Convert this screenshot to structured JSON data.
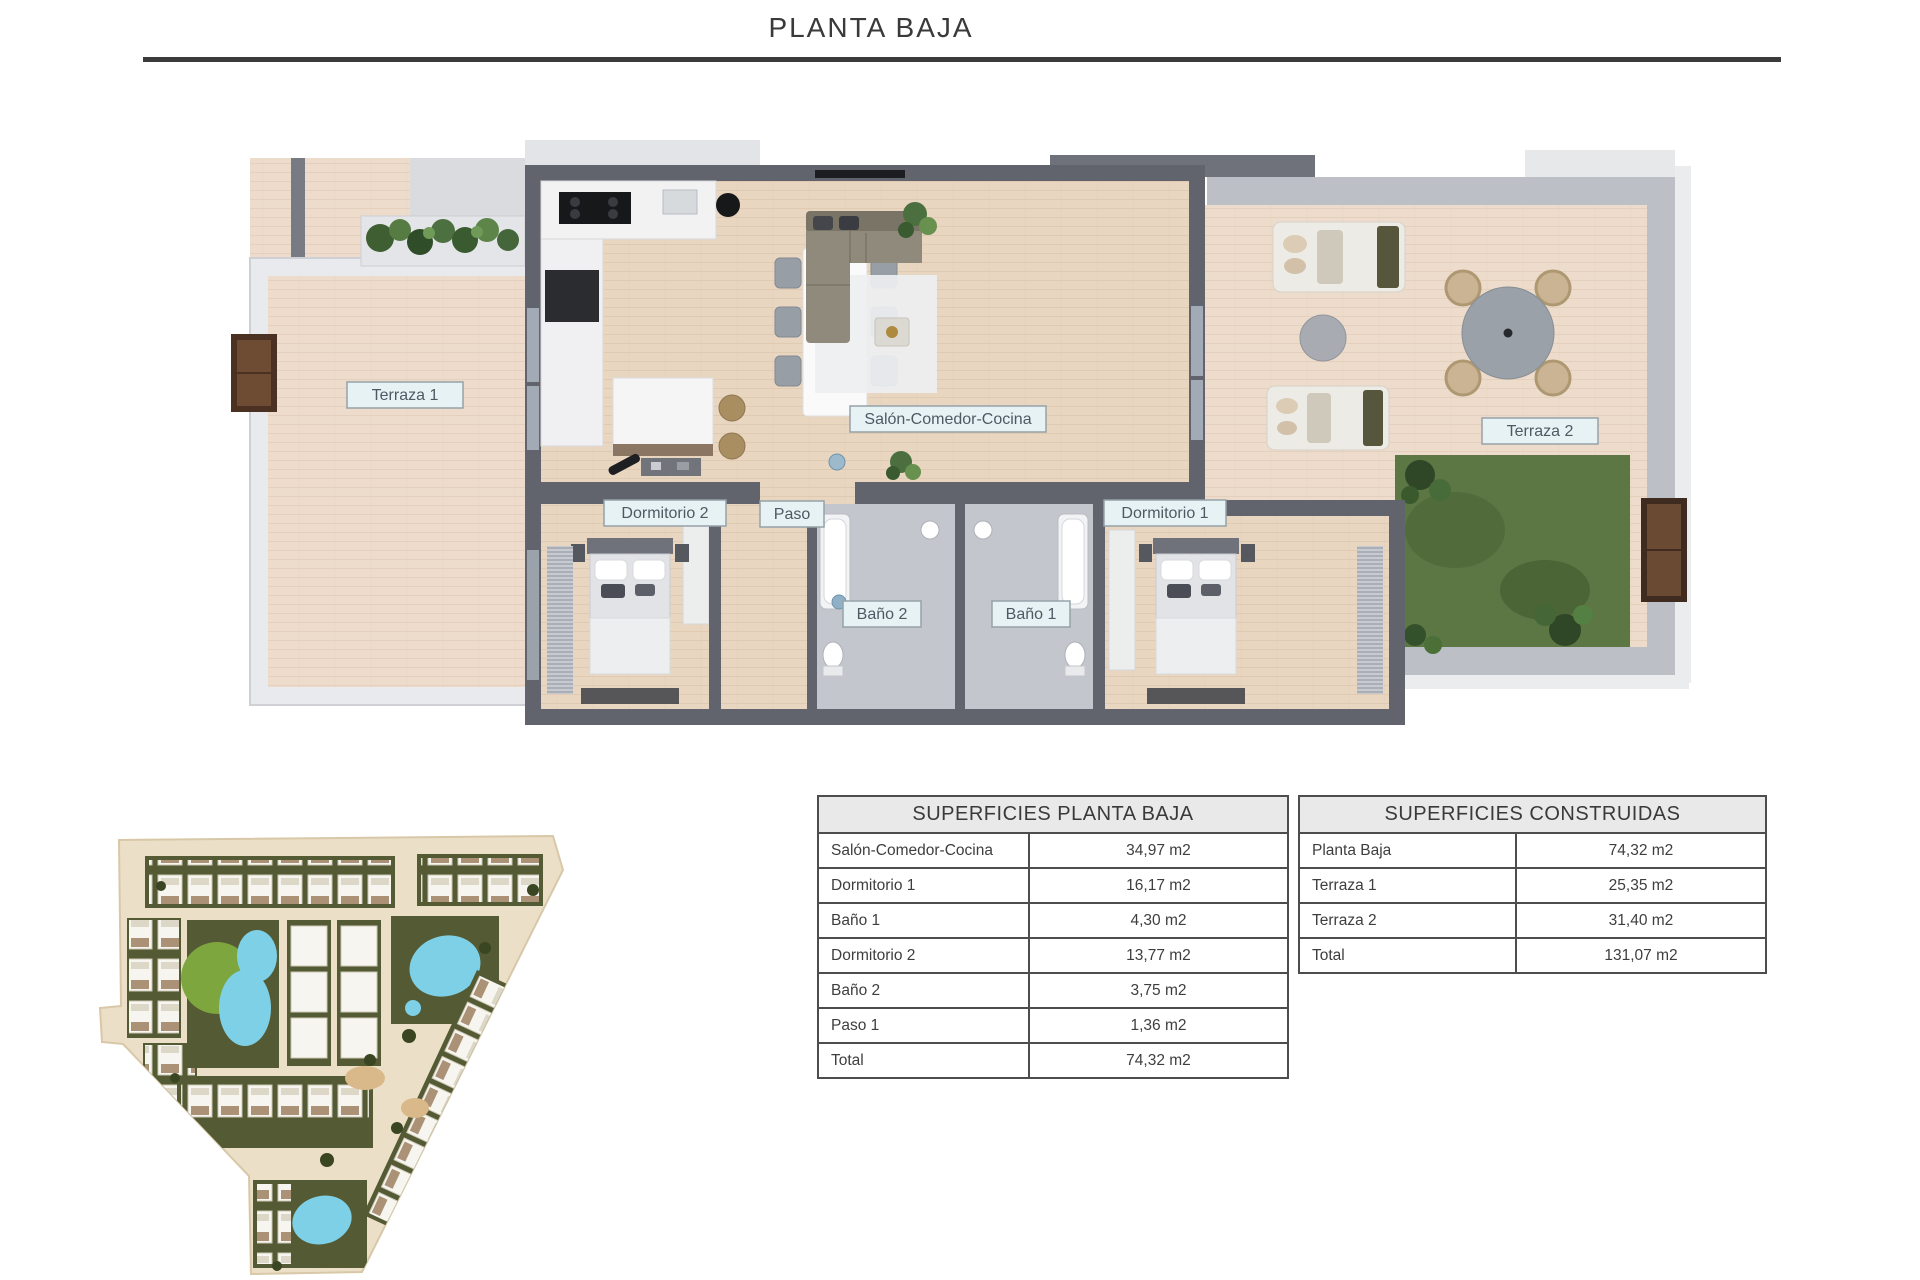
{
  "title": "PLANTA BAJA",
  "plan": {
    "labels": {
      "terraza1": "Terraza 1",
      "salon": "Salón-Comedor-Cocina",
      "dormitorio2": "Dormitorio 2",
      "paso": "Paso",
      "bano2": "Baño 2",
      "bano1": "Baño 1",
      "dormitorio1": "Dormitorio 1",
      "terraza2": "Terraza 2"
    }
  },
  "tables": {
    "planta_baja": {
      "title": "SUPERFICIES PLANTA BAJA",
      "rows": [
        {
          "label": "Salón-Comedor-Cocina",
          "value": "34,97 m2"
        },
        {
          "label": "Dormitorio 1",
          "value": "16,17 m2"
        },
        {
          "label": "Baño 1",
          "value": "4,30 m2"
        },
        {
          "label": "Dormitorio 2",
          "value": "13,77 m2"
        },
        {
          "label": "Baño 2",
          "value": "3,75 m2"
        },
        {
          "label": "Paso 1",
          "value": "1,36 m2"
        },
        {
          "label": "Total",
          "value": "74,32 m2"
        }
      ]
    },
    "construidas": {
      "title": "SUPERFICIES CONSTRUIDAS",
      "rows": [
        {
          "label": "Planta Baja",
          "value": "74,32 m2"
        },
        {
          "label": "Terraza 1",
          "value": "25,35 m2"
        },
        {
          "label": "Terraza 2",
          "value": "31,40 m2"
        },
        {
          "label": "Total",
          "value": "131,07 m2"
        }
      ]
    }
  },
  "colors": {
    "wall_dark": "#61646d",
    "wall_light": "#b9bdc4",
    "wood_floor": "#e9d6c1",
    "label_bg": "#e7f2f4",
    "pool": "#7ed0e6",
    "grass": "#5c7644",
    "rule": "#3b3b3b"
  }
}
